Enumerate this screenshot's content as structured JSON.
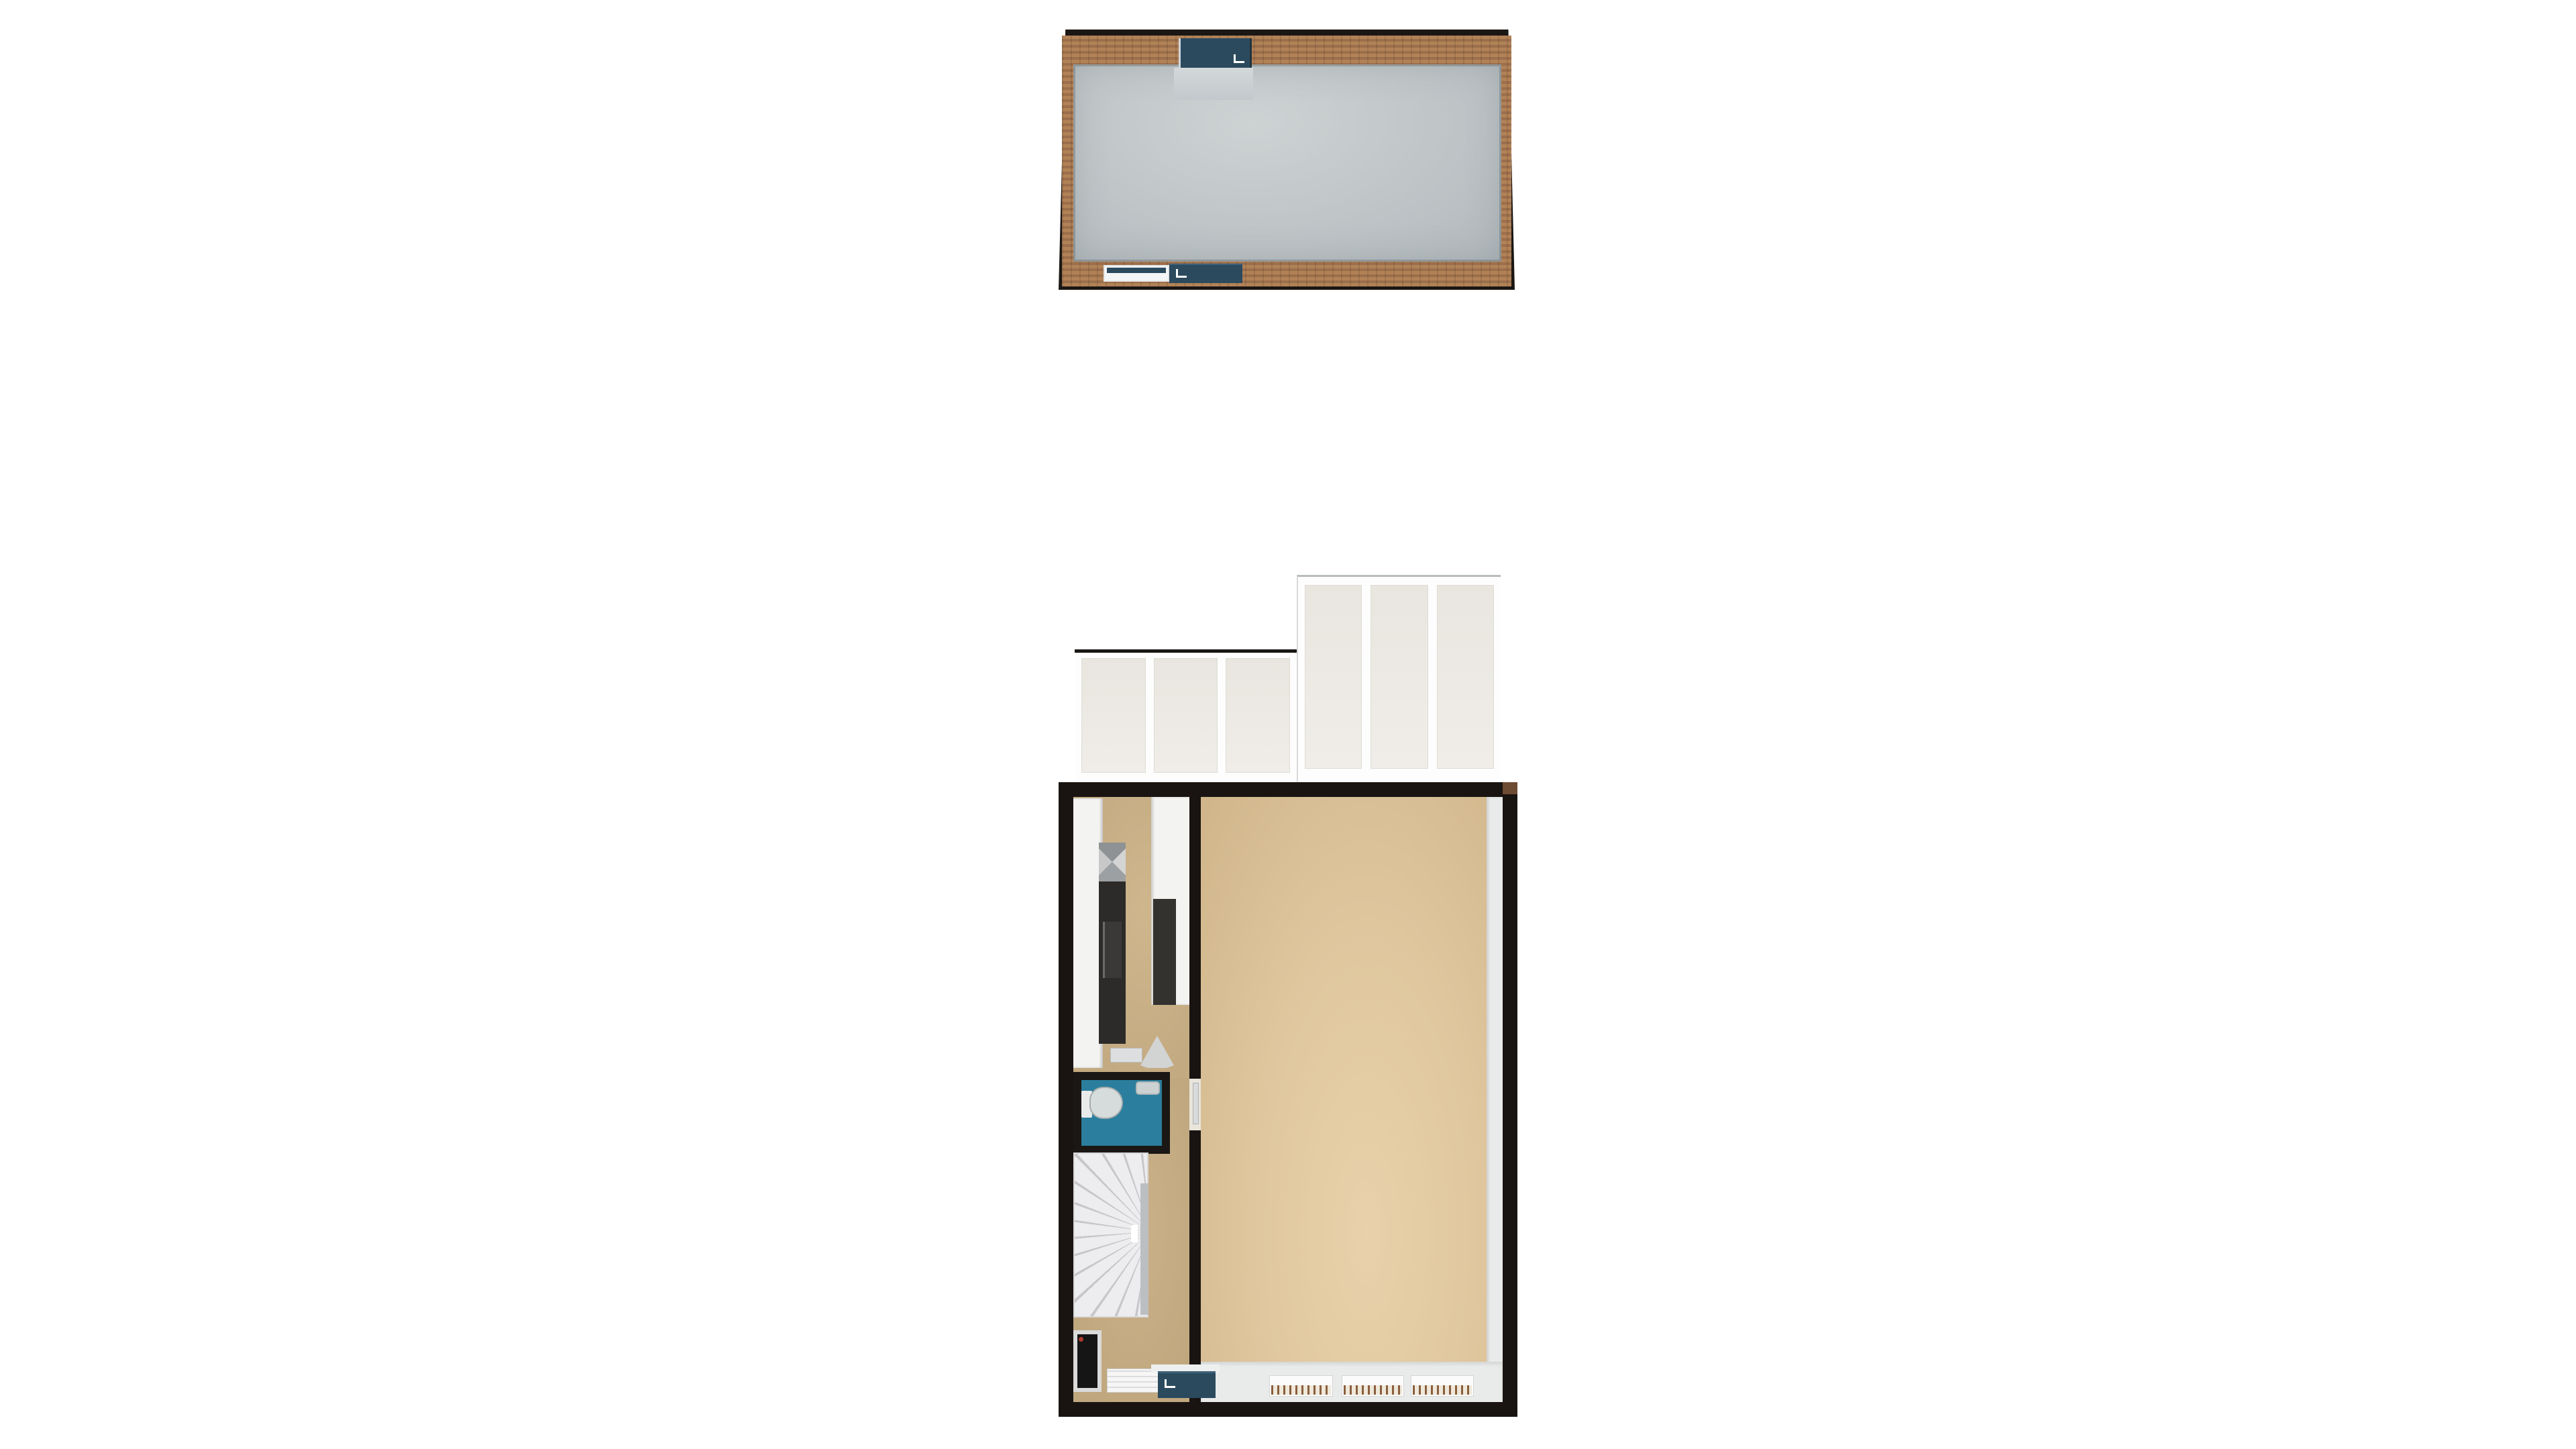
{
  "scene": {
    "type": "floor-plan-3d-render",
    "background": "#ffffff",
    "text_labels": [],
    "floors": [
      {
        "name": "upper floor",
        "position": "top of image",
        "walls": "exposed brick with black outline",
        "floor": "plain grey",
        "fixtures": [
          {
            "name": "entry door",
            "wall": "top",
            "color_ref": "teal",
            "handle": "white"
          },
          {
            "name": "window",
            "wall": "bottom",
            "frame": "white",
            "glazing_ref": "teal"
          },
          {
            "name": "door",
            "wall": "bottom",
            "color_ref": "teal",
            "handle": "white"
          }
        ]
      },
      {
        "name": "ground floor",
        "position": "bottom of image",
        "walls": "thick black",
        "rooms": [
          {
            "name": "conservatory",
            "glass_bays": {
              "left_section": 3,
              "right_section": 3
            },
            "glass_ref": "glass"
          },
          {
            "name": "kitchen",
            "floor_ref": "floor-tan-dark",
            "fixtures": [
              "left counter run",
              "dark appliance run",
              "sink drainer",
              "right counter",
              "dark cabinet",
              "shelf",
              "chair"
            ]
          },
          {
            "name": "wc",
            "floor_ref": "wc",
            "fixtures": [
              "toilet",
              "basin"
            ]
          },
          {
            "name": "staircase",
            "style": "winder with fanned treads",
            "treads_visible": 12
          },
          {
            "name": "hallway",
            "floor_ref": "floor-tan-dark",
            "fixtures": [
              "boiler recess",
              "radiator",
              "front door"
            ]
          },
          {
            "name": "living room",
            "floor_ref": "floor-tan",
            "fixtures": [
              "window sill right",
              "window sill bottom",
              "radiator",
              "radiator",
              "radiator"
            ]
          }
        ]
      }
    ]
  },
  "colors": {
    "outline": "#1a1714",
    "wall": "#191411",
    "brick-light": "#b28257",
    "brick-dark": "#9c6f4c",
    "loft-floor": "#bfc5c7",
    "teal": "#2b4a5e",
    "glass": "#ebe8e2",
    "floor-tan": "#dfc69d",
    "floor-tan-dark": "#c3aa81",
    "wc": "#2b7e9d",
    "stair": "#ededef",
    "counter": "#f3f3f2",
    "appliance": "#2d2b29",
    "sill": "#e9eaea",
    "hatch": "#8a5f3e",
    "red": "#b03a2e"
  }
}
